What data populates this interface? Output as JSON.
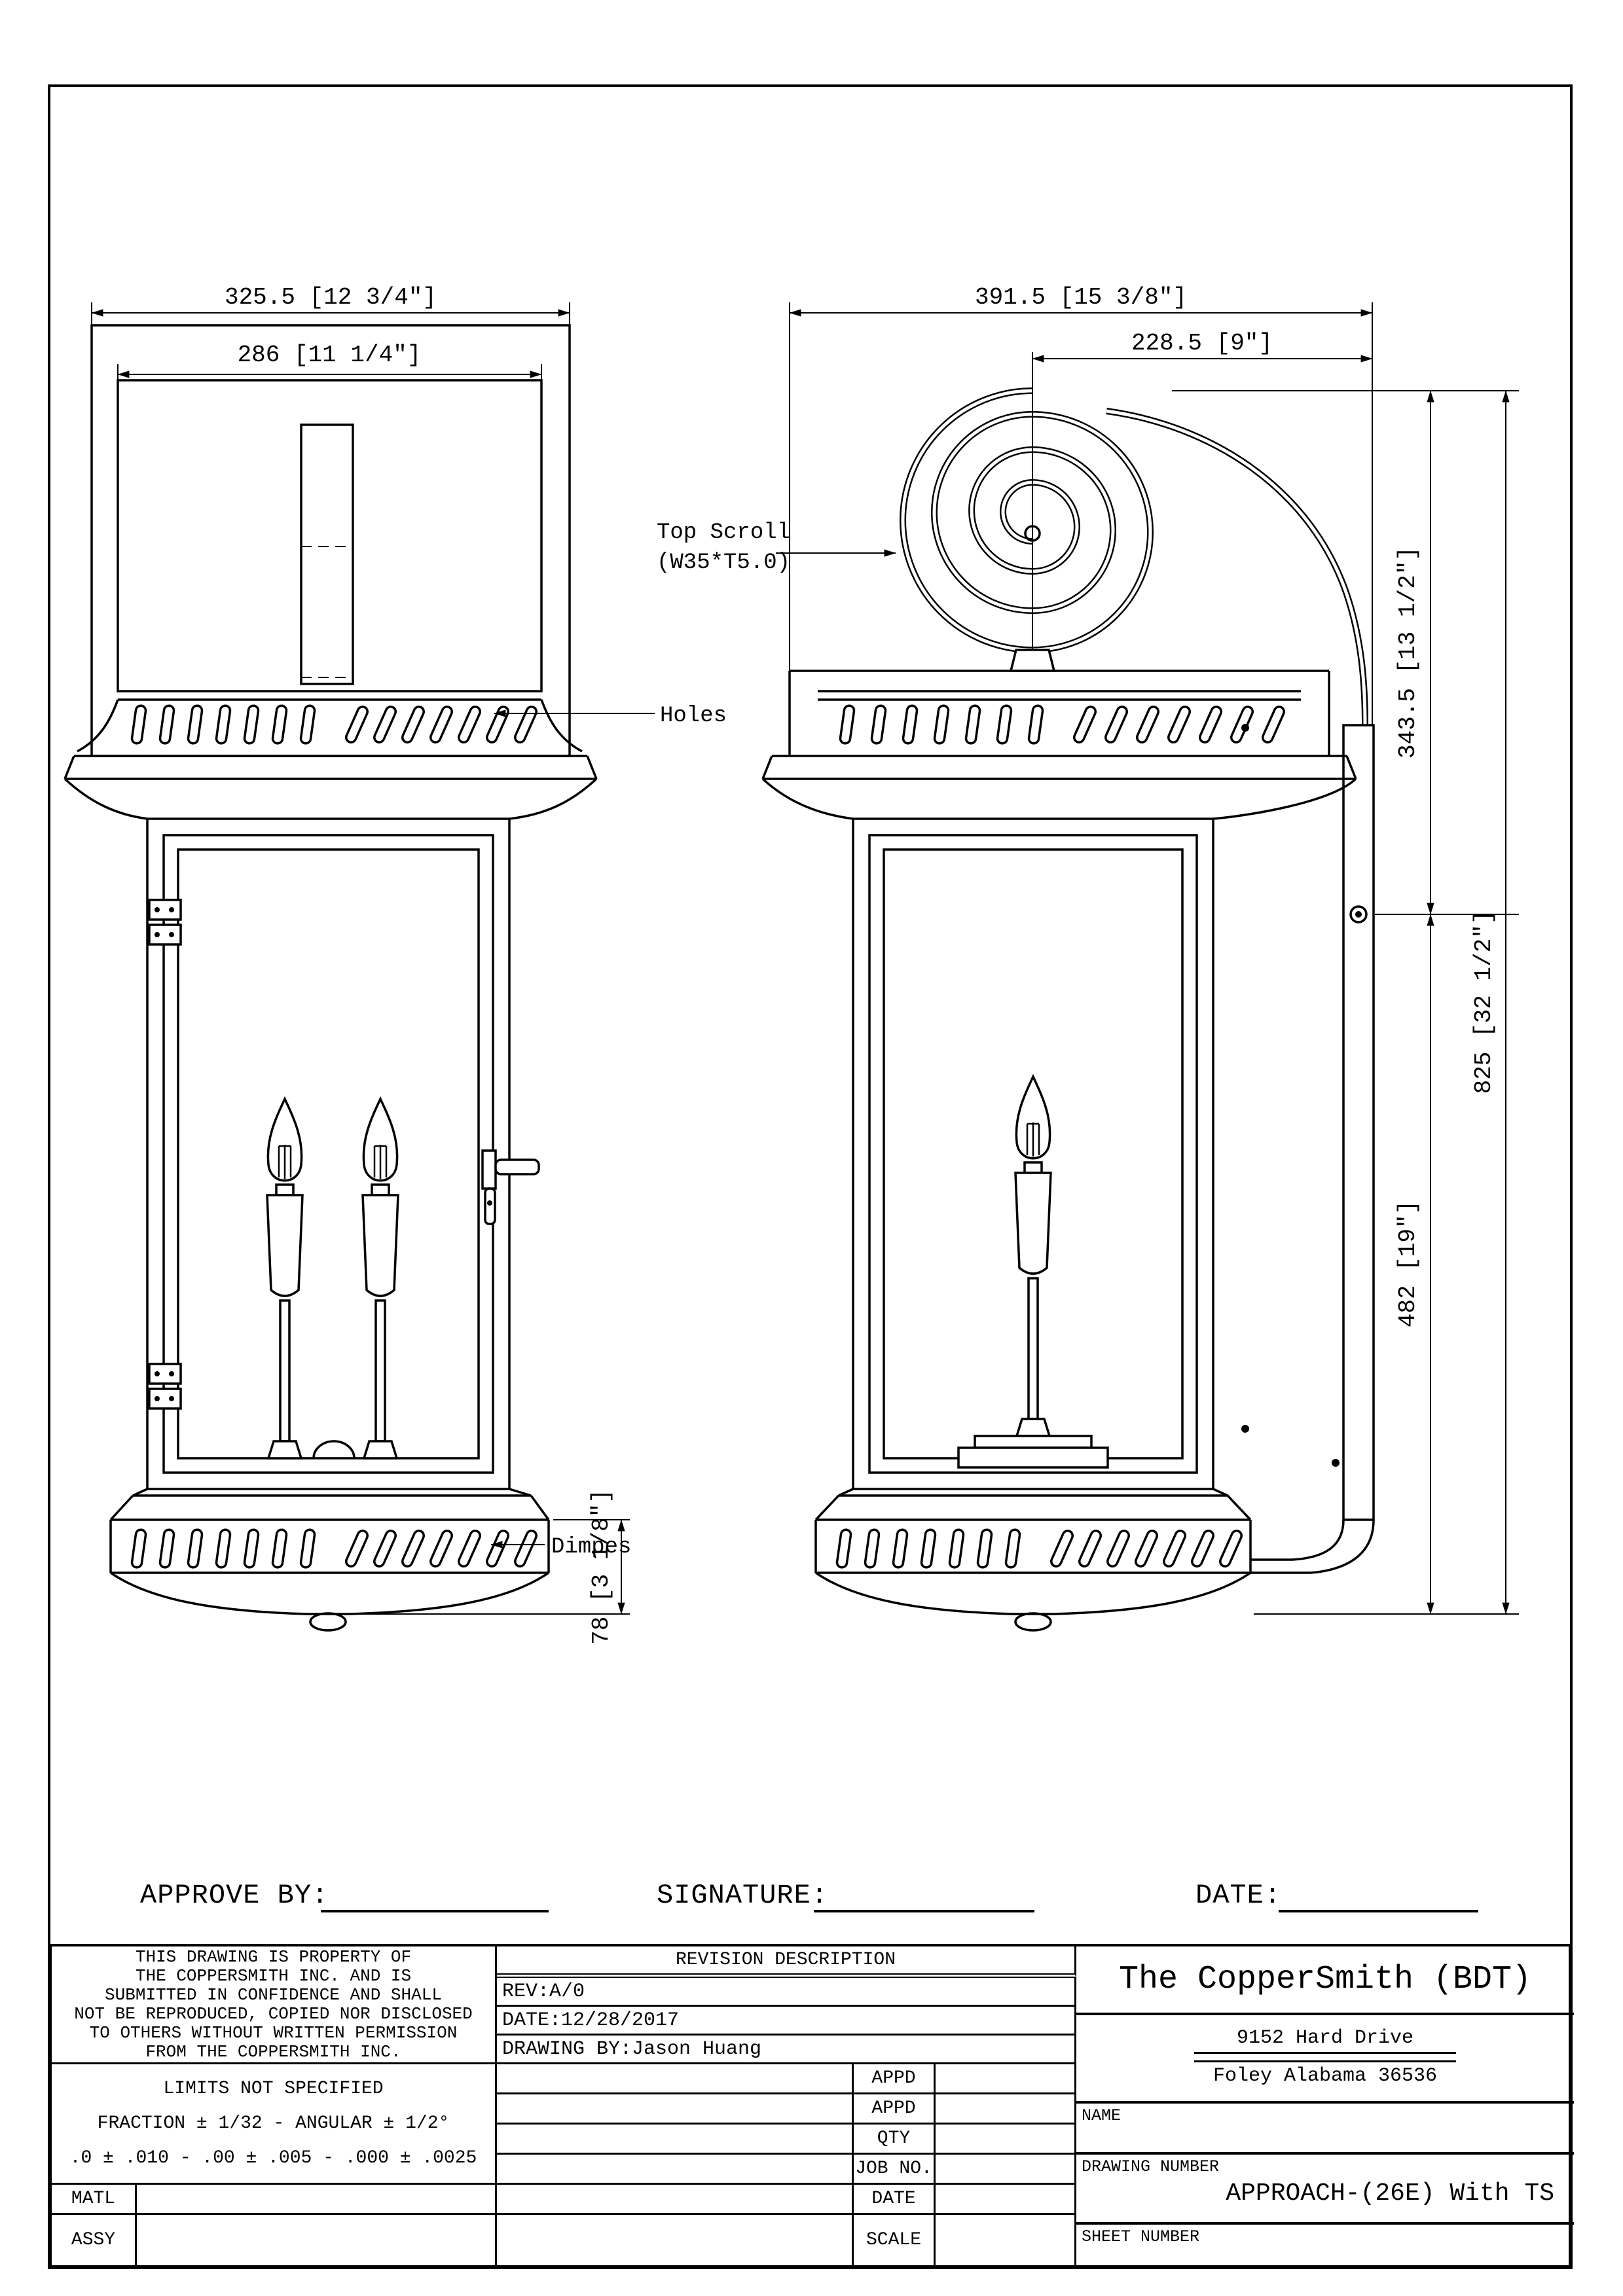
{
  "drawing": {
    "dims": {
      "front_overall_width": "325.5 [12 3/4″]",
      "front_inner_width": "286 [11 1/4″]",
      "front_base_height": "78 [3 1/8″]",
      "side_overall_width": "391.5 [15 3/8″]",
      "side_scroll_width": "228.5 [9″]",
      "side_top_height": "343.5 [13 1/2″]",
      "side_body_height": "482 [19″]",
      "side_overall_height": "825 [32 1/2″]"
    },
    "labels": {
      "top_scroll_1": "Top Scroll",
      "top_scroll_2": "(W35*T5.0)",
      "holes": "Holes",
      "dimples": "Dimpes"
    }
  },
  "signature_row": {
    "approve_by": "APPROVE BY:",
    "signature": "SIGNATURE:",
    "date": "DATE:"
  },
  "title_block": {
    "disclaimer_lines": [
      "THIS DRAWING IS PROPERTY OF",
      "THE COPPERSMITH INC. AND IS",
      "SUBMITTED IN CONFIDENCE AND SHALL",
      "NOT BE REPRODUCED, COPIED NOR DISCLOSED",
      "TO OTHERS WITHOUT WRITTEN PERMISSION",
      "FROM THE COPPERSMITH INC."
    ],
    "limits_lines": [
      "LIMITS NOT SPECIFIED",
      "FRACTION ± 1/32 - ANGULAR ± 1/2°",
      ".0 ± .010 - .00 ± .005 - .000 ± .0025"
    ],
    "matl_label": "MATL",
    "assy_label": "ASSY",
    "revision_header": "REVISION DESCRIPTION",
    "rev": "REV:A/0",
    "date": "DATE:12/28/2017",
    "drawing_by": "DRAWING BY:Jason Huang",
    "row_labels": [
      "APPD",
      "APPD",
      "QTY",
      "JOB NO.",
      "DATE",
      "SCALE"
    ],
    "company": "The CopperSmith (BDT)",
    "address_line1": "9152 Hard Drive",
    "address_line2": "Foley Alabama 36536",
    "name_label": "NAME",
    "drawing_number_label": "DRAWING NUMBER",
    "drawing_number": "APPROACH-(26E) With TS",
    "sheet_number_label": "SHEET NUMBER"
  }
}
